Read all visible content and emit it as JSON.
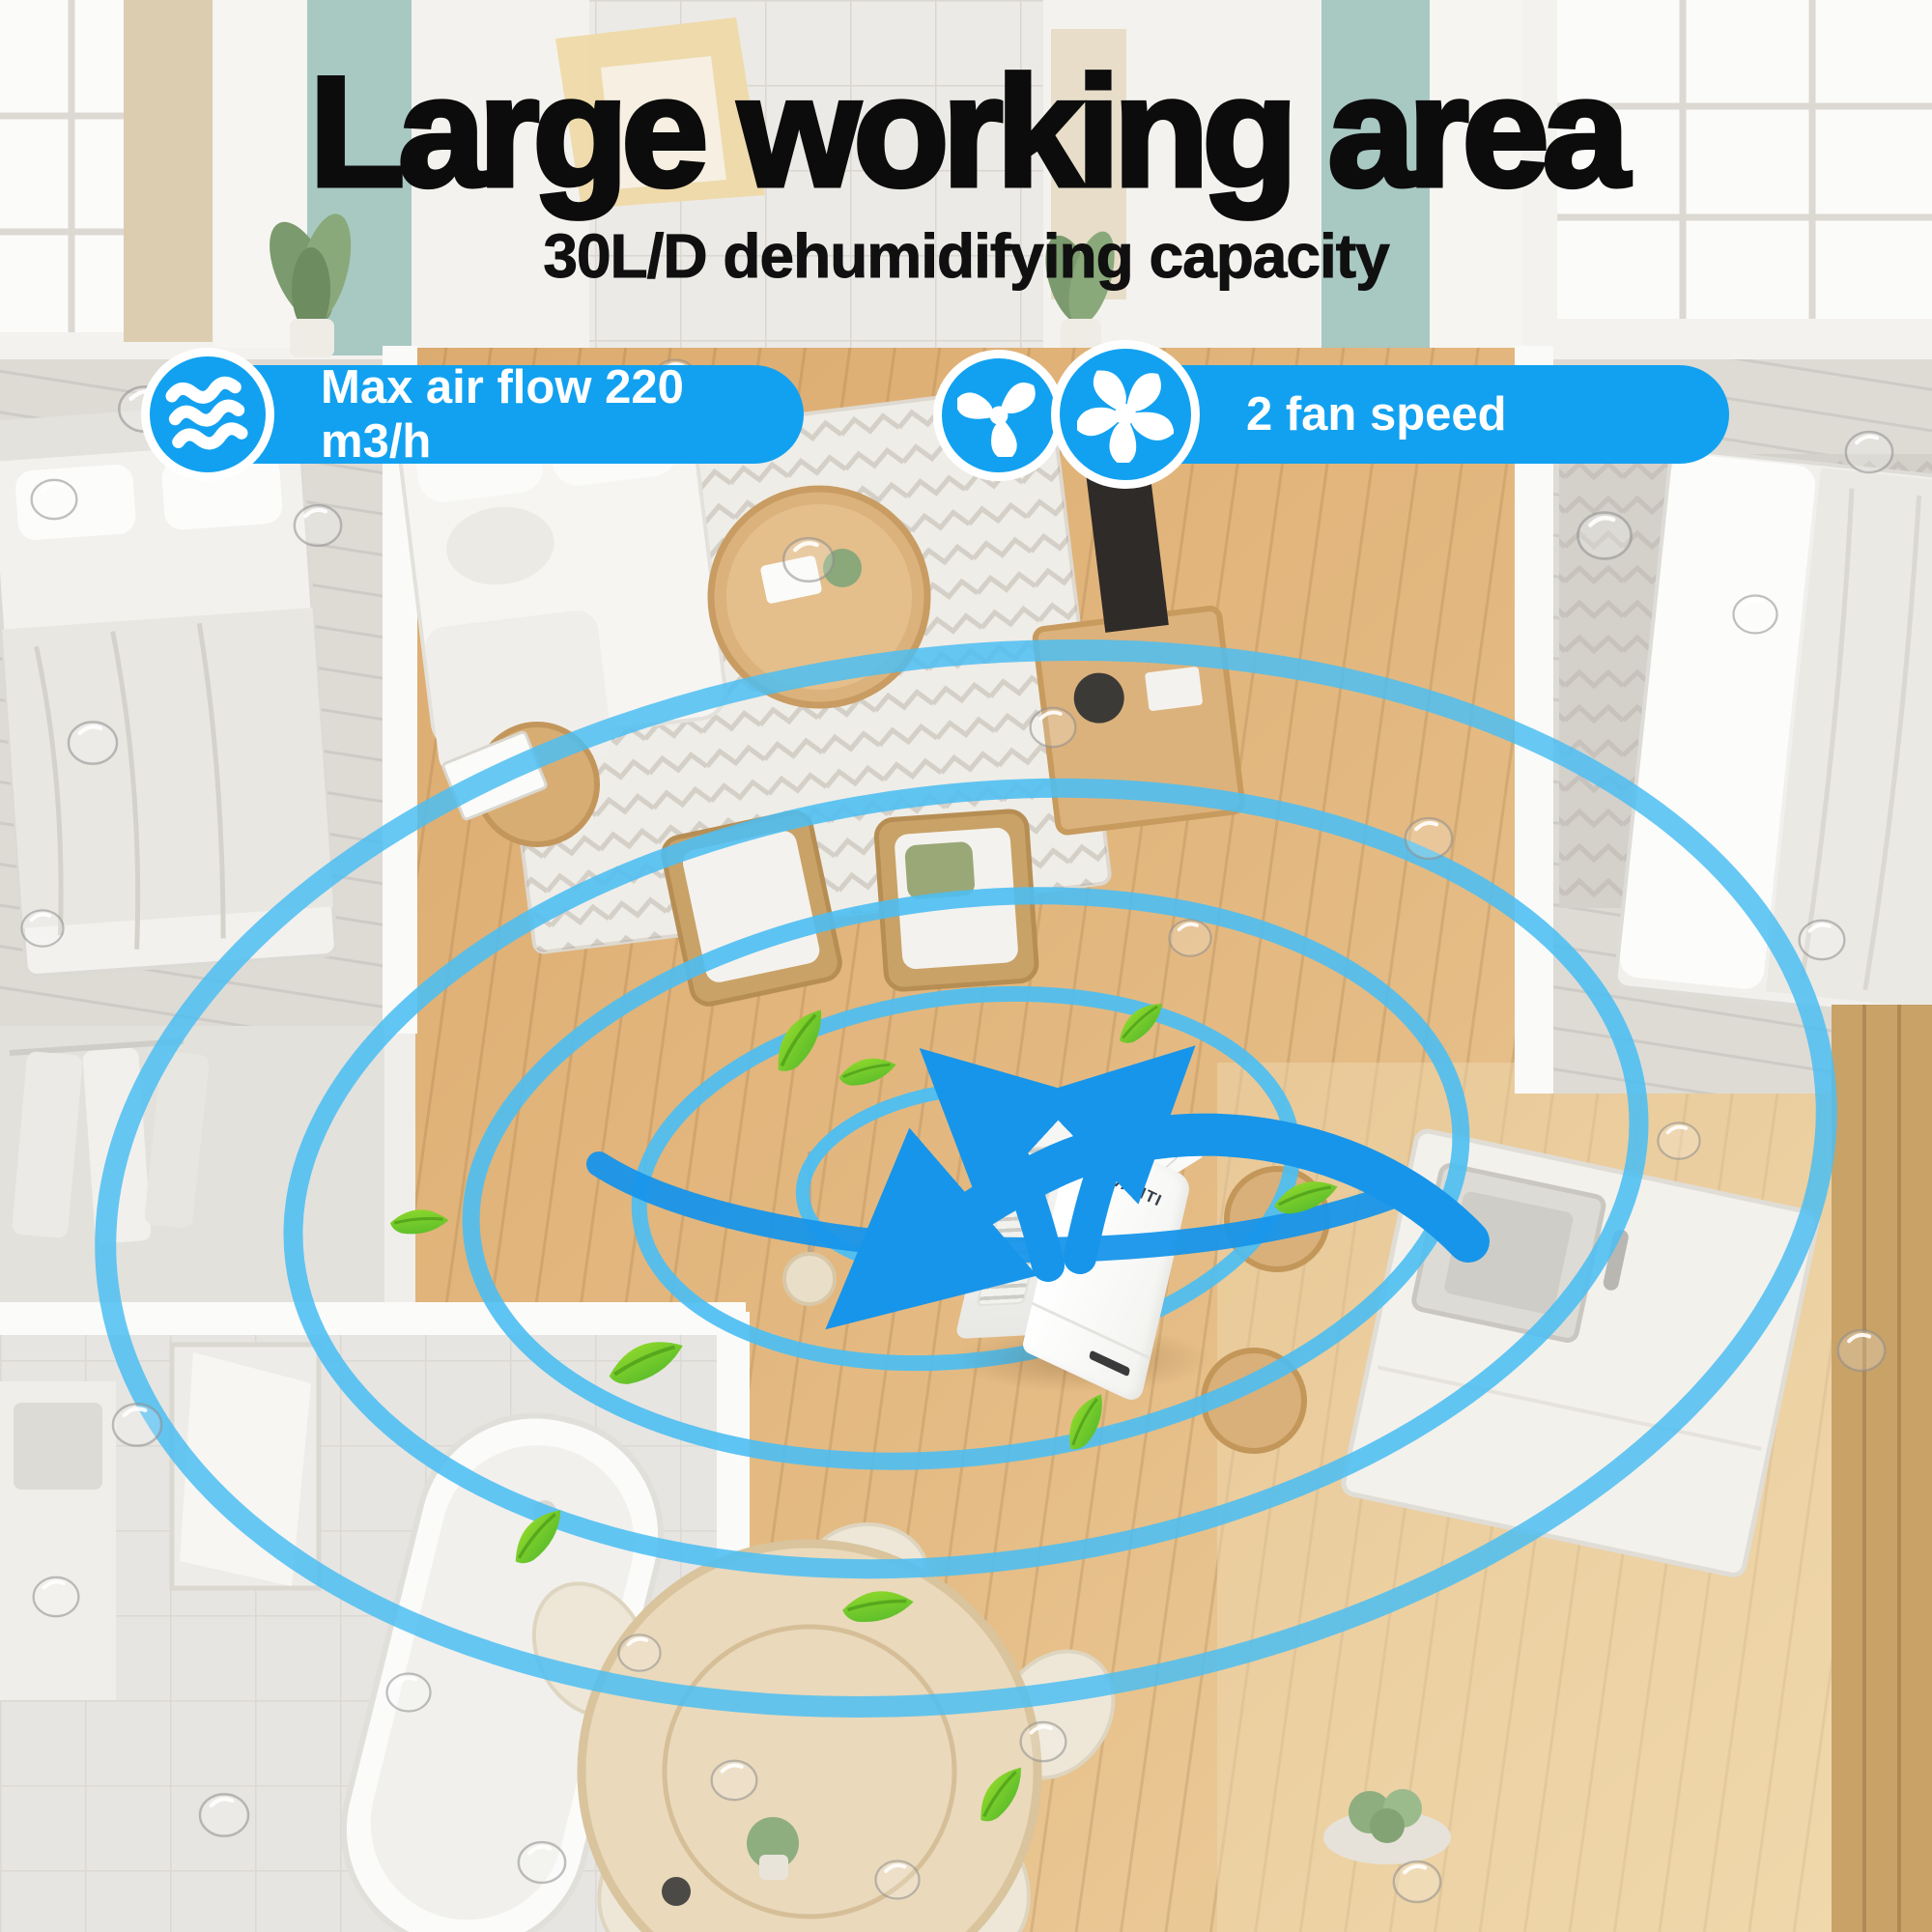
{
  "header": {
    "title": "Large working area",
    "subtitle": "30L/D dehumidifying capacity"
  },
  "badges": {
    "airflow": {
      "icon": "air-flow-wave-icon",
      "label": "Max air flow 220 m3/h"
    },
    "fan": {
      "icons": [
        "fan-three-blade-icon",
        "fan-five-blade-icon"
      ],
      "label": "2 fan speed"
    }
  },
  "product": {
    "brand_prefix": "DE",
    "brand_suffix": "VANTI"
  },
  "colors": {
    "badge_blue": "#12a1f0",
    "ring_blue": "#4cbef2",
    "arrow_blue": "#1795ea",
    "leaf_green": "#7cd61f",
    "title_black": "#0c0c0c",
    "wood_floor": "#e0b279",
    "grey_room": "#dedbd5"
  }
}
